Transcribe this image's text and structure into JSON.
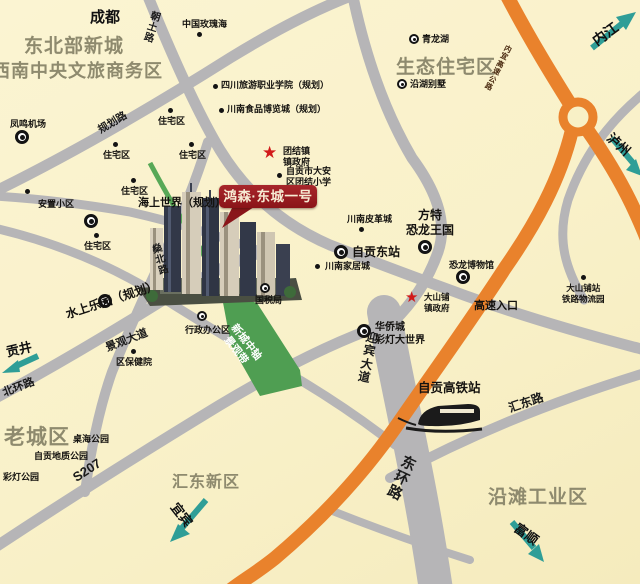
{
  "project": {
    "badge_label": "鸿森·东城一号"
  },
  "colors": {
    "background": "#f9f1c9",
    "road_gray": "#b6b5b7",
    "highway_orange": "#e9822c",
    "green_road": "#58a857",
    "teal_arrow": "#2f9e97",
    "district_text": "#8e8a6e",
    "badge_red": "#8a1418",
    "star_red": "#d11a1a"
  },
  "icons": {
    "star": "★"
  },
  "districts": {
    "northeast_newtown": "东北部新城",
    "southwest_cbd": "西南中央文旅商务区",
    "eco_residential": "生态住宅区",
    "old_town": "老城区",
    "huidong_new_area": "汇东新区",
    "yantan_industrial": "沿滩工业区"
  },
  "cities": {
    "chengdu": "成都",
    "neijiang": "内江",
    "luzhou": "泸州",
    "gongjing": "贡井",
    "yibin": "宜宾",
    "fushun": "富顺"
  },
  "roads": {
    "chaotu": "朝土路",
    "guihua": "规划路",
    "shenbei": "燊北路",
    "jingguan_avenue": "景观大道",
    "beihuan": "北环路",
    "s207": "S207",
    "yingbin_avenue": "迎宾大道",
    "donghuan": "东环路",
    "huidong_road": "汇东路",
    "expressway": "内宜高速公路"
  },
  "green_axis": {
    "line1": "新城中轴",
    "line2": "景观带"
  },
  "station": {
    "label": "自贡高铁站"
  },
  "pois": [
    {
      "label": "中国玫瑰海"
    },
    {
      "label": "四川旅游职业学院（规划）"
    },
    {
      "label": "川南食品博览城（规划）"
    },
    {
      "label": "青龙湖"
    },
    {
      "label": "沿湖别墅"
    },
    {
      "label": "凤鸣机场"
    },
    {
      "label": "住宅区"
    },
    {
      "label": "住宅区"
    },
    {
      "label": "住宅区"
    },
    {
      "label": "住宅区"
    },
    {
      "label": "住宅区"
    },
    {
      "label": "安置小区"
    },
    {
      "line1": "团结镇",
      "line2": "镇政府"
    },
    {
      "line1": "自贡市大安",
      "line2": "区团结小学"
    },
    {
      "label": "海上世界（规划）"
    },
    {
      "label": "水上乐园（规划）"
    },
    {
      "label": "区保健院"
    },
    {
      "label": "国税局"
    },
    {
      "label": "行政办公区"
    },
    {
      "label": "川南皮革城"
    },
    {
      "label": "自贡东站"
    },
    {
      "label": "川南家居城"
    },
    {
      "line1": "方特",
      "line2": "恐龙王国"
    },
    {
      "label": "恐龙博物馆"
    },
    {
      "line1": "大山铺",
      "line2": "镇政府"
    },
    {
      "label": "高速入口"
    },
    {
      "line1": "大山铺站",
      "line2": "铁路物流园"
    },
    {
      "line1": "华侨城",
      "line2": "彩灯大世界"
    },
    {
      "label": "桌海公园"
    },
    {
      "label": "自贡地质公园"
    },
    {
      "label": "彩灯公园"
    }
  ]
}
